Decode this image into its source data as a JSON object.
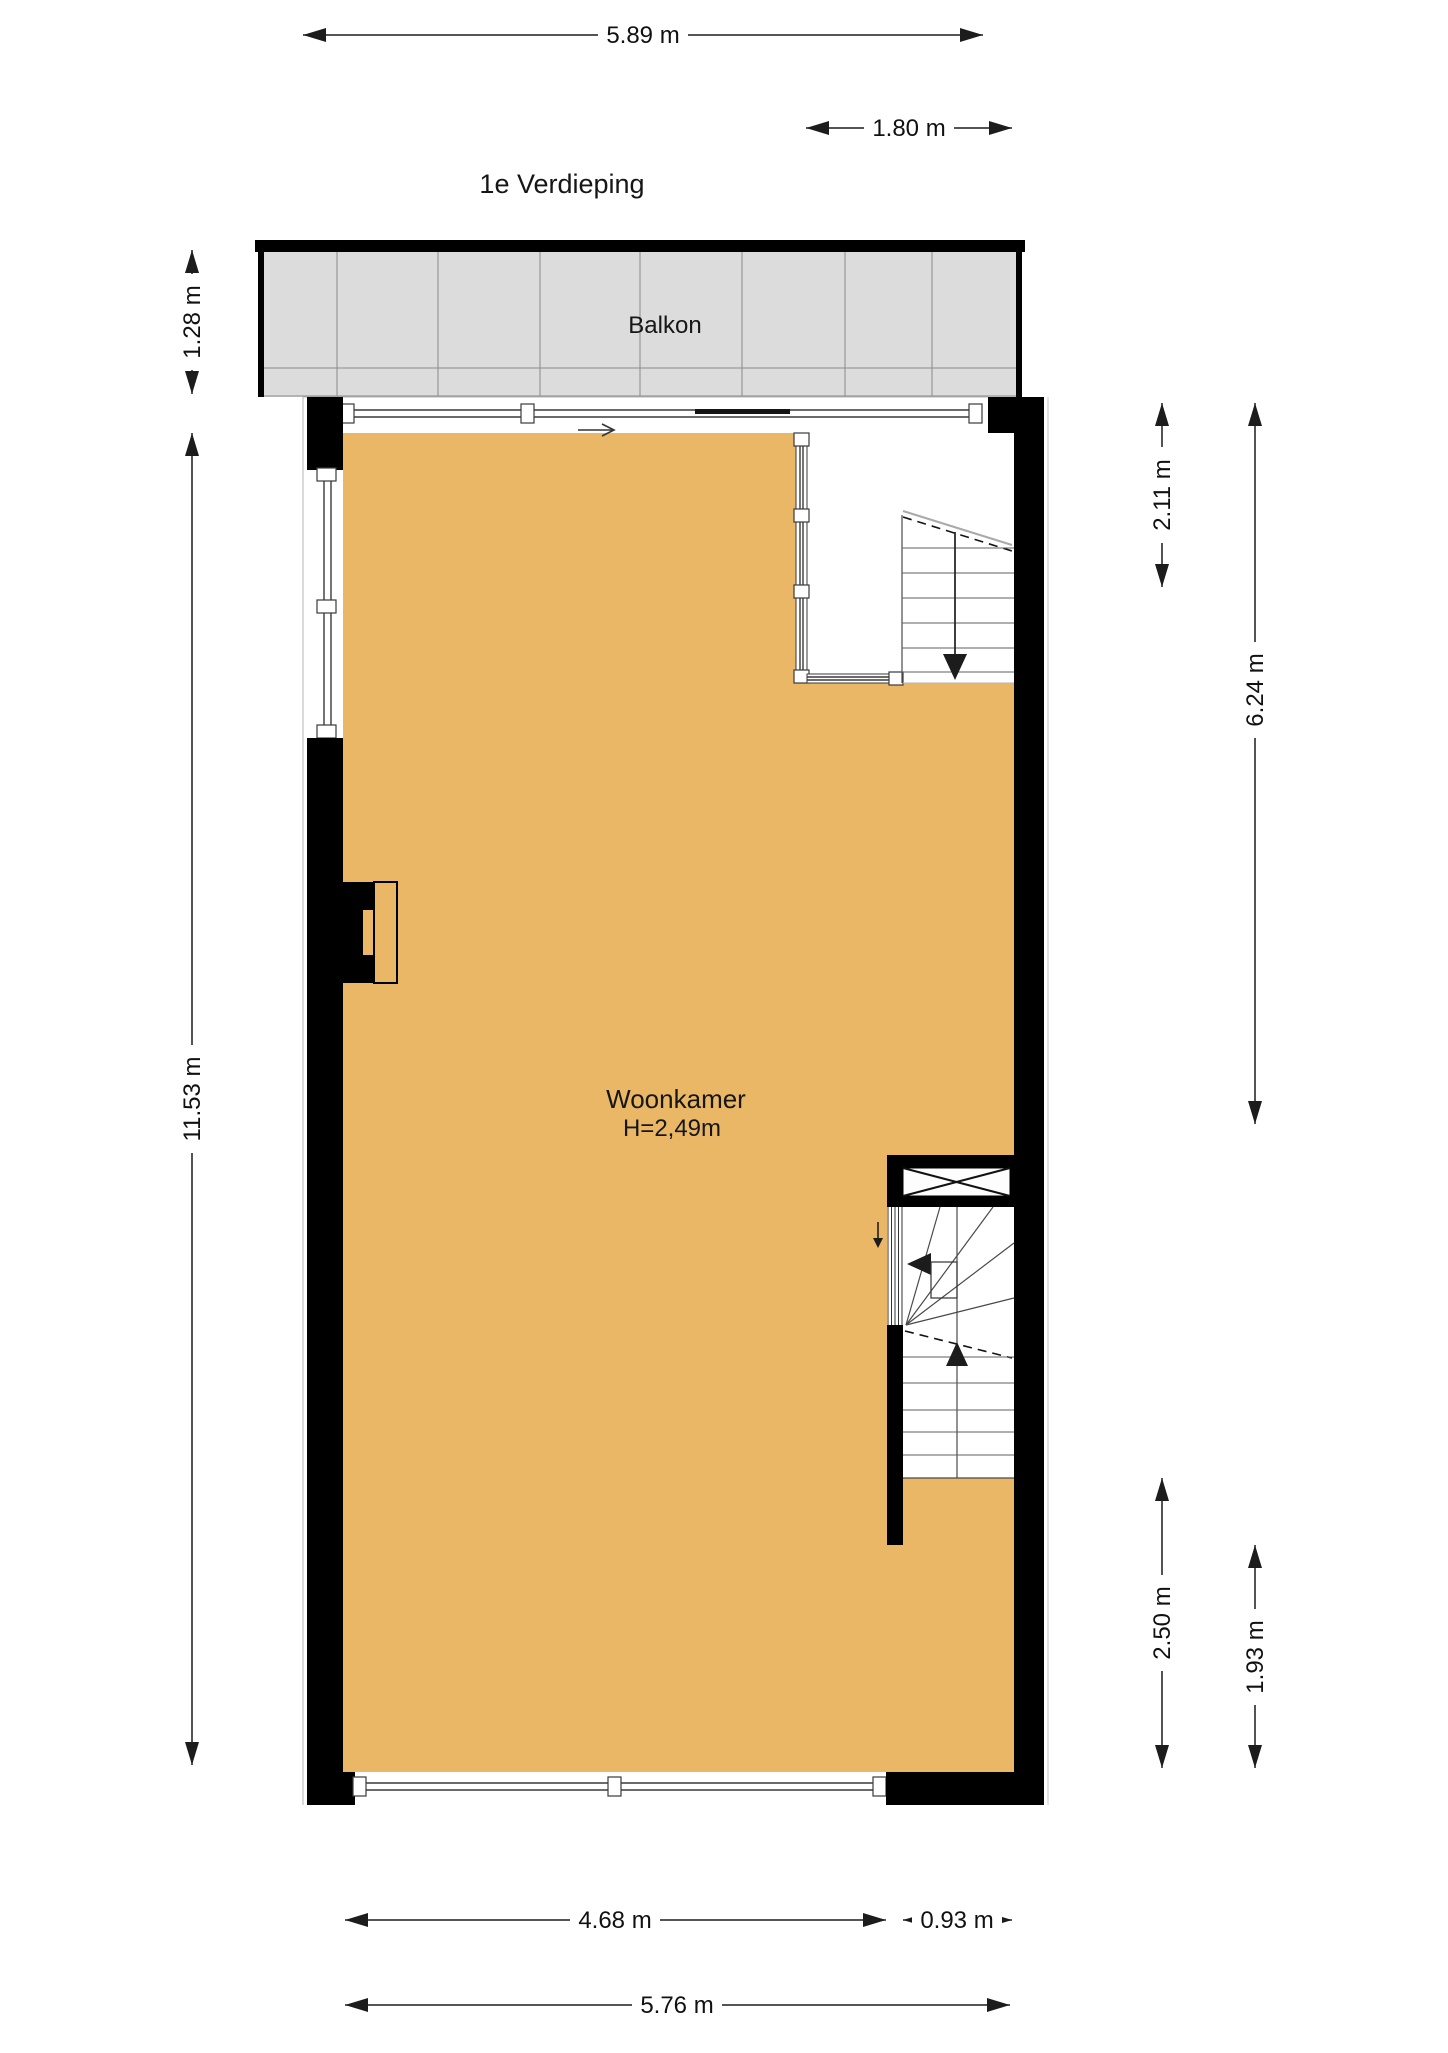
{
  "title": "1e Verdieping",
  "rooms": {
    "balcony": {
      "label": "Balkon"
    },
    "living_room": {
      "label": "Woonkamer",
      "ceiling_height": "H=2,49m"
    }
  },
  "dimensions": {
    "top_width": "5.89 m",
    "stairwell_width": "1.80 m",
    "balcony_depth": "1.28 m",
    "left_height": "11.53 m",
    "stairwell_height": "2.11 m",
    "right_upper_height": "6.24 m",
    "right_mid_height": "2.50 m",
    "right_lower_height": "1.93 m",
    "bottom_left_width": "4.68 m",
    "bottom_right_width": "0.93 m",
    "bottom_total_width": "5.76 m"
  },
  "colors": {
    "floor": "#eab766",
    "balcony_floor": "#dcdcdc",
    "wall": "#000000"
  }
}
